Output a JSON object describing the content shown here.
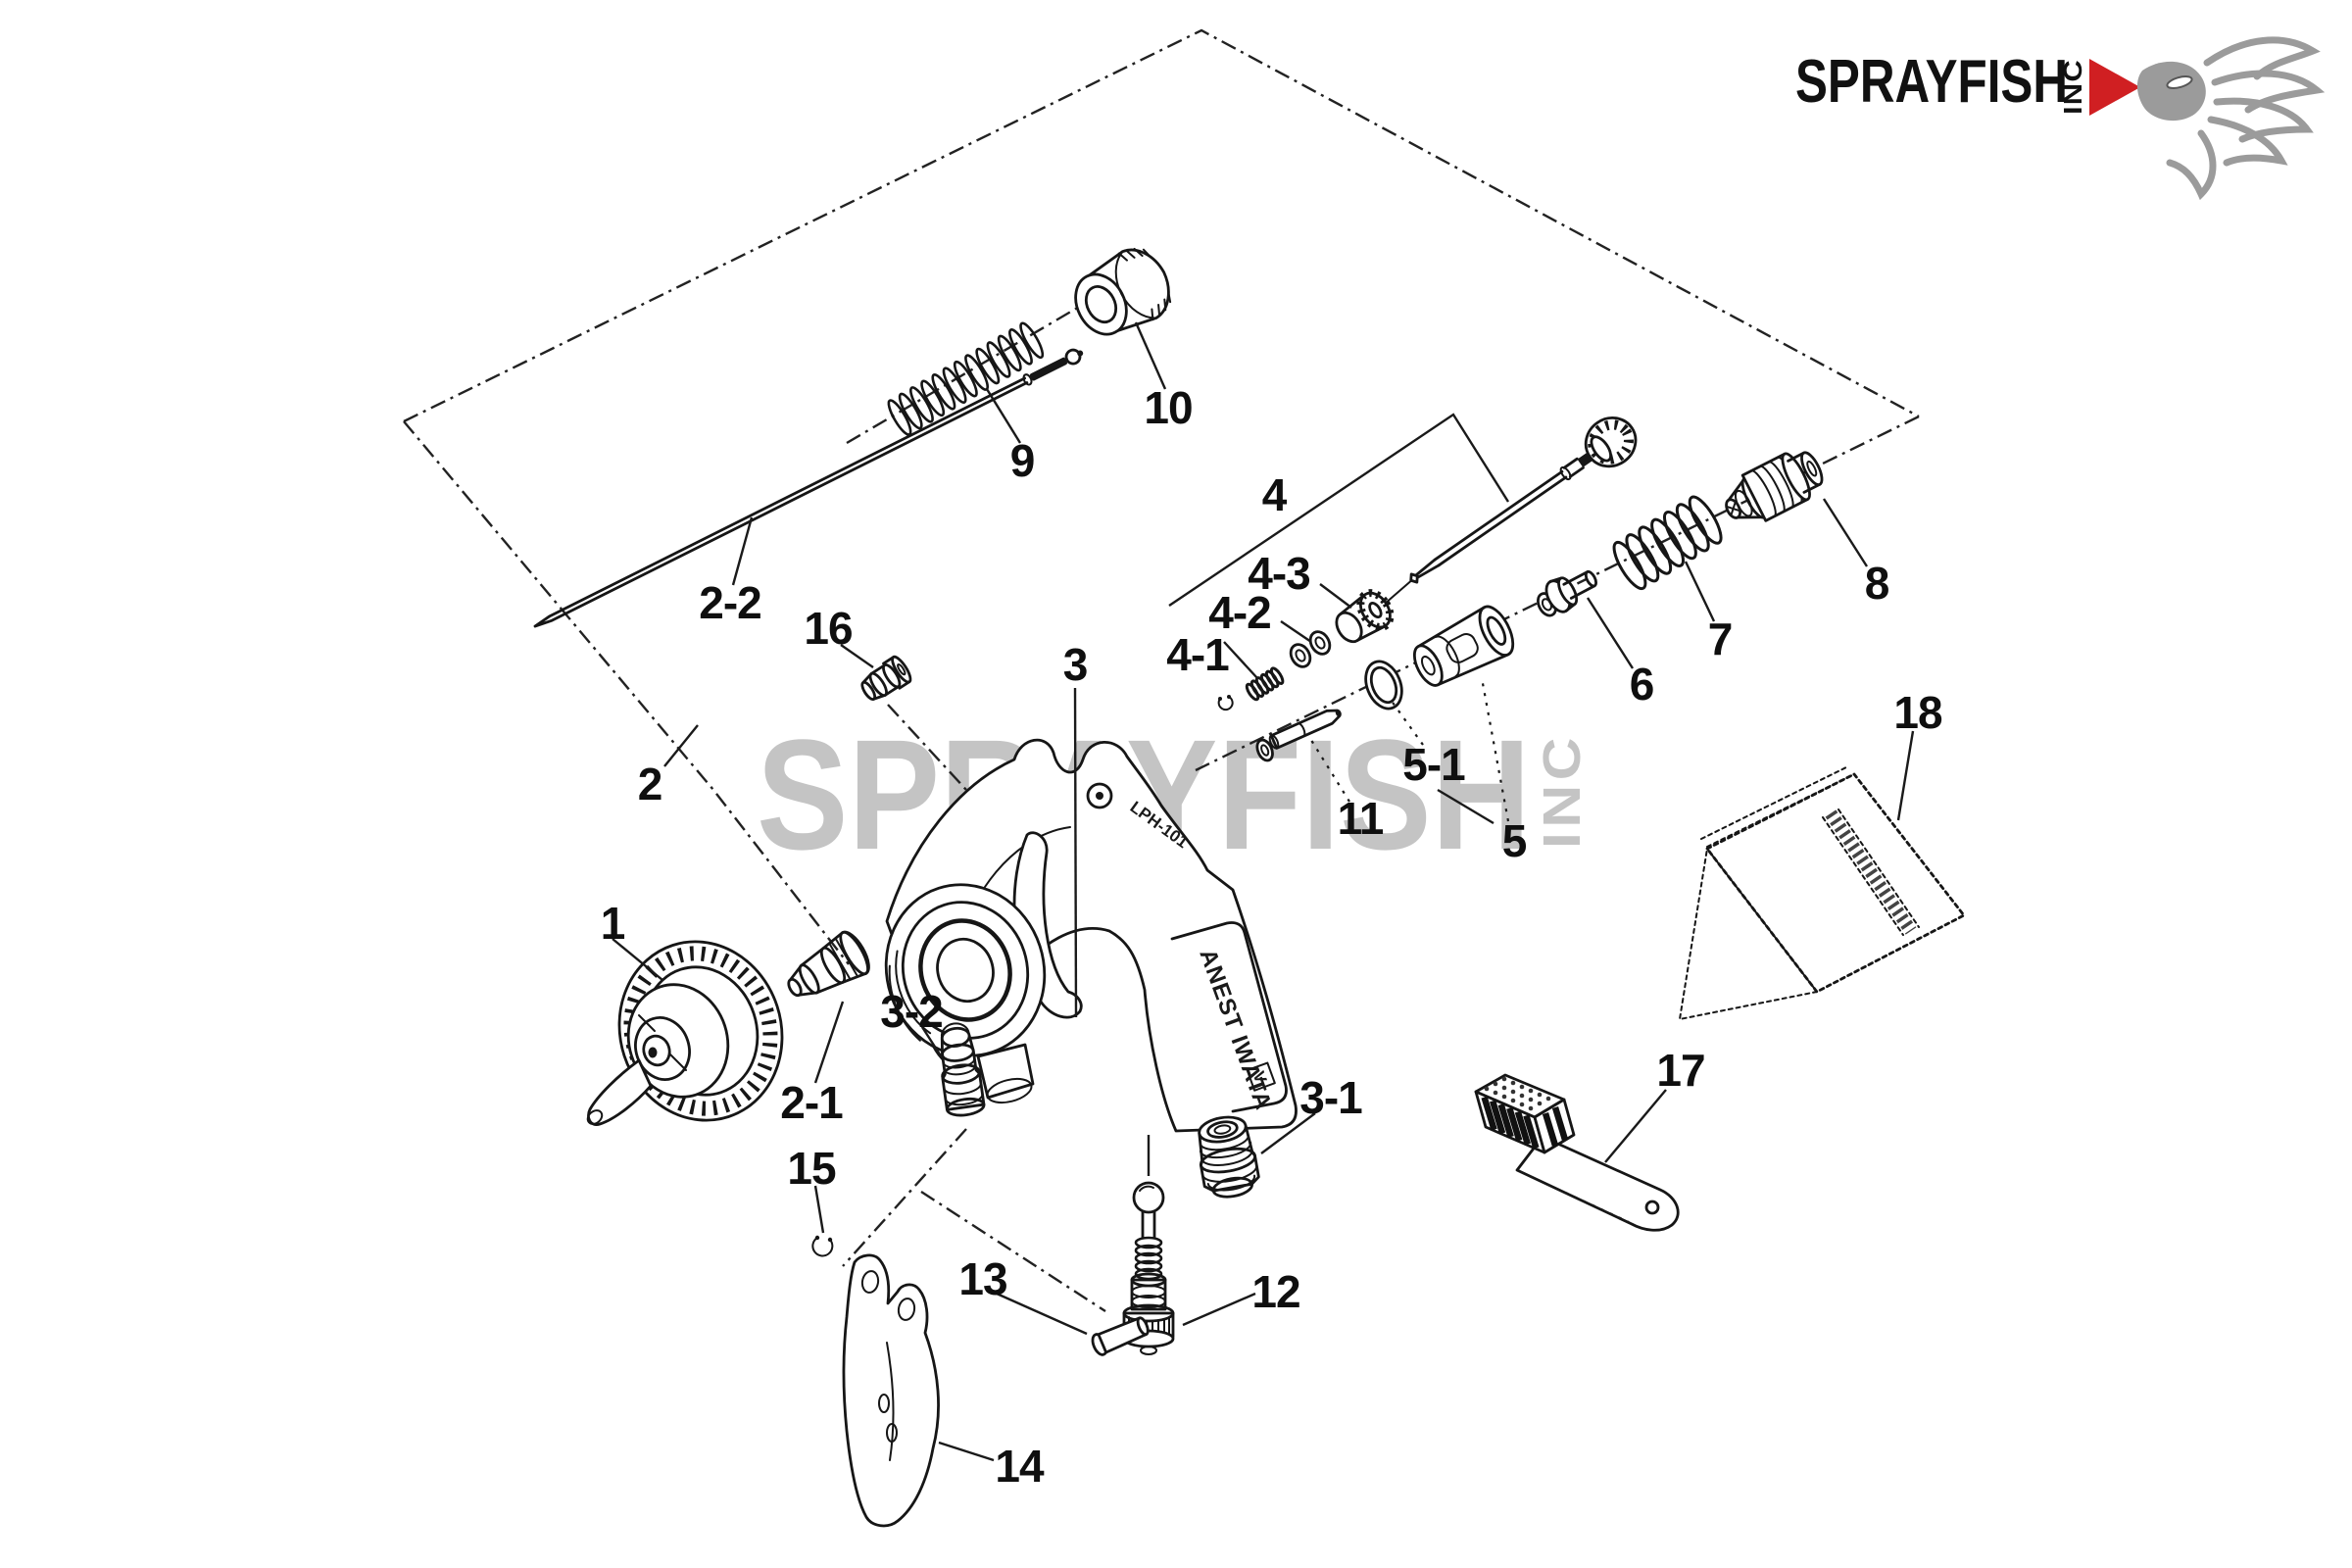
{
  "watermark": {
    "text": "SPRAYFISH",
    "suffix": "INC",
    "color": "#c4c4c4"
  },
  "logo": {
    "brand": "SPRAYFISH",
    "suffix": "INC",
    "accent_color": "#d01f22",
    "fish_color": "#9b9b9b"
  },
  "gun": {
    "body_text": "LPH-101",
    "handle_text": "ANEST IWATA",
    "handle_mark": "V"
  },
  "diagram": {
    "labels": [
      {
        "id": "part-1",
        "text": "1"
      },
      {
        "id": "part-2",
        "text": "2"
      },
      {
        "id": "part-2-1",
        "text": "2-1"
      },
      {
        "id": "part-2-2",
        "text": "2-2"
      },
      {
        "id": "part-3",
        "text": "3"
      },
      {
        "id": "part-3-1",
        "text": "3-1"
      },
      {
        "id": "part-3-2",
        "text": "3-2"
      },
      {
        "id": "part-4",
        "text": "4"
      },
      {
        "id": "part-4-1",
        "text": "4-1"
      },
      {
        "id": "part-4-2",
        "text": "4-2"
      },
      {
        "id": "part-4-3",
        "text": "4-3"
      },
      {
        "id": "part-5",
        "text": "5"
      },
      {
        "id": "part-5-1",
        "text": "5-1"
      },
      {
        "id": "part-6",
        "text": "6"
      },
      {
        "id": "part-7",
        "text": "7"
      },
      {
        "id": "part-8",
        "text": "8"
      },
      {
        "id": "part-9",
        "text": "9"
      },
      {
        "id": "part-10",
        "text": "10"
      },
      {
        "id": "part-11",
        "text": "11"
      },
      {
        "id": "part-12",
        "text": "12"
      },
      {
        "id": "part-13",
        "text": "13"
      },
      {
        "id": "part-14",
        "text": "14"
      },
      {
        "id": "part-15",
        "text": "15"
      },
      {
        "id": "part-16",
        "text": "16"
      },
      {
        "id": "part-17",
        "text": "17"
      },
      {
        "id": "part-18",
        "text": "18"
      }
    ]
  }
}
